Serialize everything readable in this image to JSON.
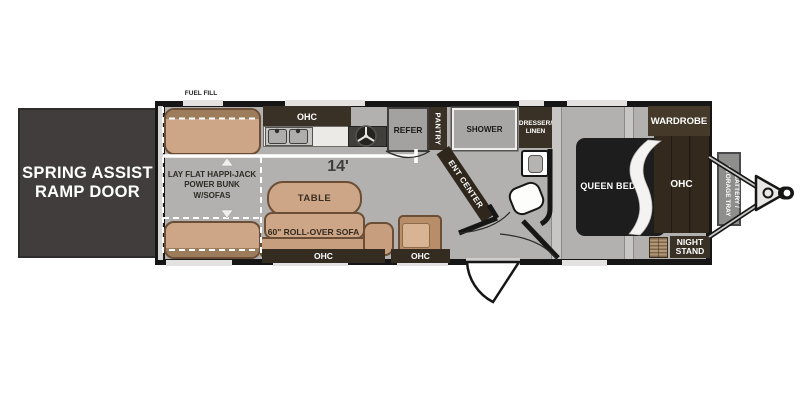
{
  "plan_type": "travel-trailer floorplan",
  "colors": {
    "floor": "#b2b1af",
    "wall": "#161616",
    "cabinet": "#3a3126",
    "furniture_tan": "#cda687",
    "appliance_gray": "#a3a2a0",
    "bed_black": "#1d1d1d",
    "ramp_gray": "#413d3d"
  },
  "ramp": {
    "label": "SPRING ASSIST\nRAMP DOOR"
  },
  "exterior": {
    "fuel_fill": "FUEL FILL",
    "battery_tray": "BATTERY /\nSTORAGE TRAY"
  },
  "garage": {
    "bunk": "LAY FLAT HAPPI-JACK\nPOWER BUNK\nW/SOFAS",
    "dimension": "14'"
  },
  "kitchen": {
    "ohc": "OHC",
    "refer": "REFER",
    "pantry": "PANTRY"
  },
  "living": {
    "table": "TABLE",
    "sofa": "60\" ROLL-OVER SOFA",
    "ohc_left": "OHC",
    "ohc_right": "OHC"
  },
  "bath": {
    "shower": "SHOWER",
    "dresser": "DRESSER/\nLINEN",
    "ent_center": "ENT CENTER"
  },
  "bedroom": {
    "queen_bed": "QUEEN BED",
    "wardrobe": "WARDROBE",
    "ohc": "OHC",
    "night_stand": "NIGHT\nSTAND"
  }
}
